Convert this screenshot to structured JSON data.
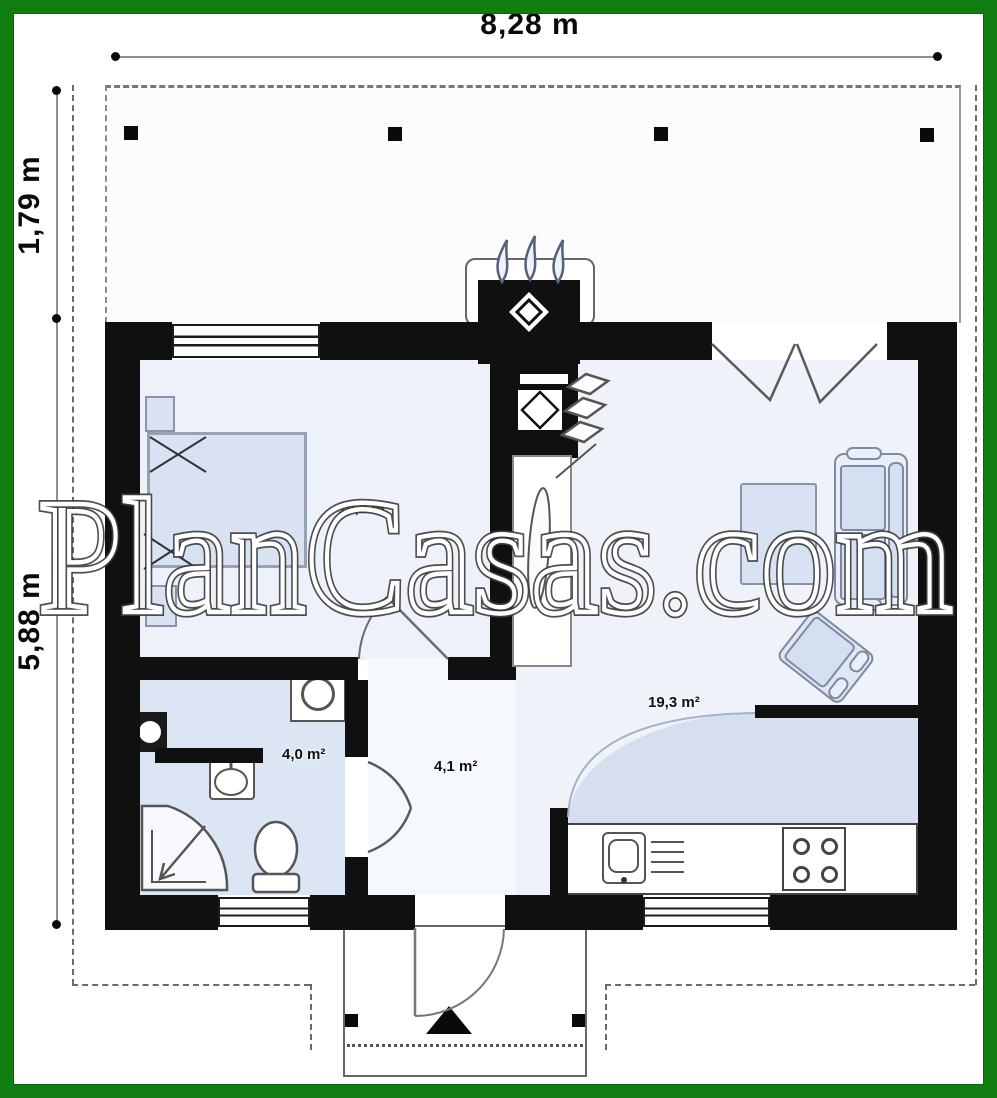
{
  "watermark": "PlanCasas.com",
  "dimensions": {
    "terrace_width": "8,28 m",
    "terrace_depth": "1,79 m",
    "house_depth": "5,88 m"
  },
  "rooms": {
    "bedroom": {
      "name": "bedroom",
      "area": "10,2 m²"
    },
    "bathroom": {
      "name": "bathroom",
      "area": "4,0 m²"
    },
    "hall": {
      "name": "hall",
      "area": "4,1 m²"
    },
    "living_kitchen": {
      "name": "living-kitchen",
      "area": "19,3 m²"
    }
  },
  "colors": {
    "frame_green": "#0f7d0f",
    "wall_black": "#101010",
    "furniture_blue": "#d9e2f3",
    "bathroom_floor": "#dce5f3",
    "kitchen_floor": "#d5dff0"
  }
}
